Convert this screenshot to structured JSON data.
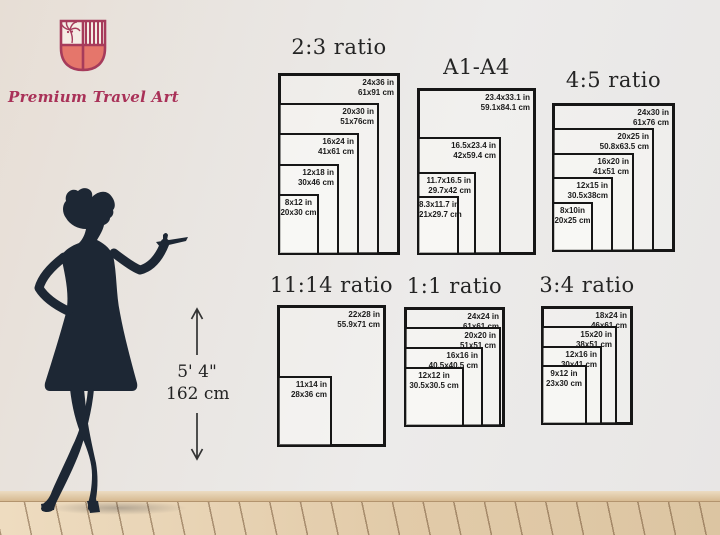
{
  "brand": {
    "name": "Premium Travel Art"
  },
  "icons": {
    "logo": "shield-palm-crest-icon",
    "up_arrow": "arrow-up-icon",
    "down_arrow": "arrow-down-icon",
    "figure": "woman-silhouette"
  },
  "colors": {
    "crest_outline": "#a63b5b",
    "crest_fill": "#e5766b",
    "brand_text": "#a93158",
    "silhouette": "#1d2734",
    "rect_border": "#161616",
    "wall": "#eae7e3",
    "floor": "#e2cba9"
  },
  "height_marker": {
    "imperial": "5' 4\"",
    "metric": "162 cm"
  },
  "chart_data": [
    {
      "type": "nested-rectangles",
      "title": "2:3 ratio",
      "box": {
        "left": 278,
        "top": 73,
        "width": 122,
        "height": 182,
        "title_gap": 14
      },
      "sizes": [
        {
          "inches": "24x36 in",
          "cm": "61x91 cm",
          "w": 122,
          "h": 182
        },
        {
          "inches": "20x30 in",
          "cm": "51x76cm",
          "w": 101,
          "h": 152
        },
        {
          "inches": "16x24 in",
          "cm": "41x61 cm",
          "w": 81,
          "h": 122
        },
        {
          "inches": "12x18 in",
          "cm": "30x46 cm",
          "w": 61,
          "h": 91
        },
        {
          "inches": "8x12 in",
          "cm": "20x30 cm",
          "w": 41,
          "h": 61,
          "align": "center"
        }
      ]
    },
    {
      "type": "nested-rectangles",
      "title": "A1-A4",
      "box": {
        "left": 417,
        "top": 88,
        "width": 119,
        "height": 167,
        "title_gap": 9
      },
      "sizes": [
        {
          "inches": "23.4x33.1 in",
          "cm": "59.1x84.1 cm",
          "w": 119,
          "h": 167
        },
        {
          "inches": "16.5x23.4 in",
          "cm": "42x59.4 cm",
          "w": 84,
          "h": 118
        },
        {
          "inches": "11.7x16.5 in",
          "cm": "29.7x42 cm",
          "w": 59,
          "h": 83
        },
        {
          "inches": "8.3x11.7 in",
          "cm": "21x29.7 cm",
          "w": 42,
          "h": 59,
          "align": "center"
        }
      ]
    },
    {
      "type": "nested-rectangles",
      "title": "4:5 ratio",
      "box": {
        "left": 552,
        "top": 103,
        "width": 123,
        "height": 149,
        "title_gap": 11
      },
      "sizes": [
        {
          "inches": "24x30 in",
          "cm": "61x76 cm",
          "w": 123,
          "h": 149
        },
        {
          "inches": "20x25 in",
          "cm": "50.8x63.5 cm",
          "w": 102,
          "h": 124
        },
        {
          "inches": "16x20 in",
          "cm": "41x51 cm",
          "w": 82,
          "h": 99
        },
        {
          "inches": "12x15 in",
          "cm": "30.5x38cm",
          "w": 61,
          "h": 75
        },
        {
          "inches": "8x10in",
          "cm": "20x25 cm",
          "w": 41,
          "h": 50,
          "align": "center"
        }
      ]
    },
    {
      "type": "nested-rectangles",
      "title": "11:14 ratio",
      "box": {
        "left": 277,
        "top": 305,
        "width": 109,
        "height": 142,
        "title_gap": 8
      },
      "sizes": [
        {
          "inches": "22x28 in",
          "cm": "55.9x71 cm",
          "w": 109,
          "h": 142
        },
        {
          "inches": "11x14 in",
          "cm": "28x36 cm",
          "w": 55,
          "h": 71
        }
      ]
    },
    {
      "type": "nested-rectangles",
      "title": "1:1 ratio",
      "box": {
        "left": 404,
        "top": 307,
        "width": 101,
        "height": 120,
        "title_gap": 9
      },
      "sizes": [
        {
          "inches": "24x24 in",
          "cm": "61x61 cm",
          "w": 101,
          "h": 120
        },
        {
          "inches": "20x20 in",
          "cm": "51x51 cm",
          "w": 97,
          "h": 100
        },
        {
          "inches": "16x16 in",
          "cm": "40.5x40.5 cm",
          "w": 79,
          "h": 80
        },
        {
          "inches": "12x12 in",
          "cm": "30.5x30.5 cm",
          "w": 60,
          "h": 60,
          "align": "center"
        }
      ]
    },
    {
      "type": "nested-rectangles",
      "title": "3:4 ratio",
      "box": {
        "left": 541,
        "top": 306,
        "width": 92,
        "height": 119,
        "title_gap": 9
      },
      "sizes": [
        {
          "inches": "18x24 in",
          "cm": "46x61 cm",
          "w": 92,
          "h": 119
        },
        {
          "inches": "15x20 in",
          "cm": "38x51 cm",
          "w": 76,
          "h": 99
        },
        {
          "inches": "12x16 in",
          "cm": "30x41 cm",
          "w": 61,
          "h": 79
        },
        {
          "inches": "9x12 in",
          "cm": "23x30 cm",
          "w": 46,
          "h": 60,
          "align": "center"
        }
      ]
    }
  ]
}
